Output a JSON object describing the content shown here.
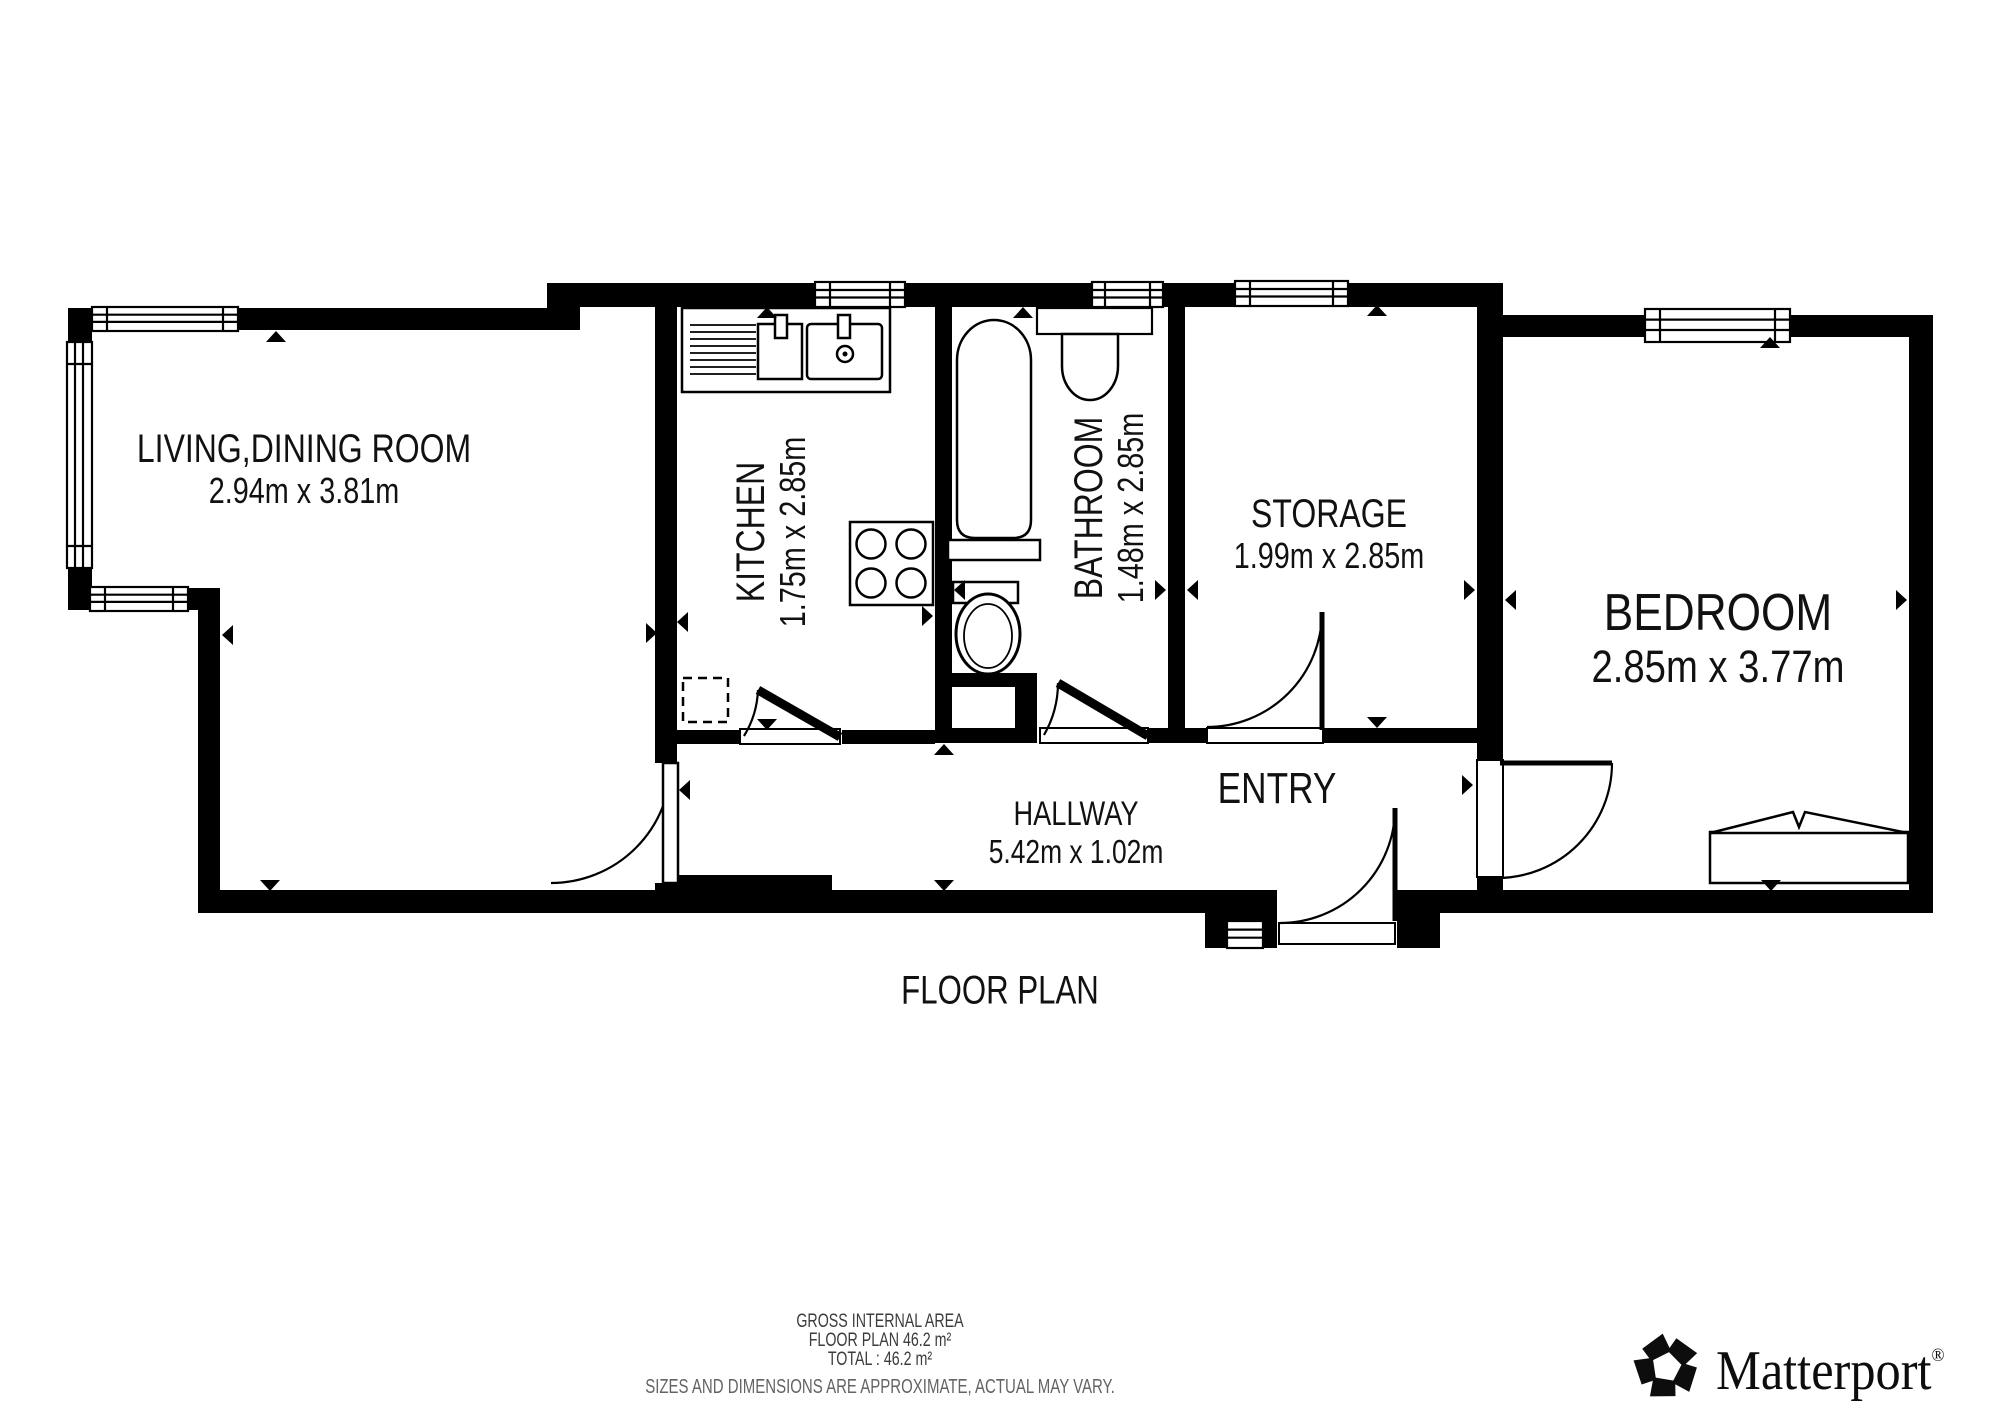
{
  "page": {
    "background": "#ffffff",
    "wall_color": "#000000",
    "label_color": "#111111"
  },
  "title": {
    "label": "FLOOR PLAN"
  },
  "rooms": [
    {
      "id": "living",
      "name": "LIVING,DINING ROOM",
      "dims": "2.94m x 3.81m"
    },
    {
      "id": "kitchen",
      "name": "KITCHEN",
      "dims": "1.75m x 2.85m"
    },
    {
      "id": "bathroom",
      "name": "BATHROOM",
      "dims": "1.48m x 2.85m"
    },
    {
      "id": "storage",
      "name": "STORAGE",
      "dims": "1.99m x 2.85m"
    },
    {
      "id": "bedroom",
      "name": "BEDROOM",
      "dims": "2.85m x 3.77m"
    },
    {
      "id": "hallway",
      "name": "HALLWAY",
      "dims": "5.42m x 1.02m"
    },
    {
      "id": "entry",
      "name": "ENTRY",
      "dims": ""
    }
  ],
  "footer": {
    "line1": "GROSS INTERNAL AREA",
    "line2": "FLOOR PLAN 46.2 m²",
    "line3": "TOTAL :  46.2 m²",
    "disclaimer": "SIZES AND DIMENSIONS ARE APPROXIMATE, ACTUAL MAY VARY.",
    "primary_color": "#3c3c3c",
    "secondary_color": "#646464"
  },
  "brand": {
    "name": "Matterport",
    "registered": "®"
  }
}
